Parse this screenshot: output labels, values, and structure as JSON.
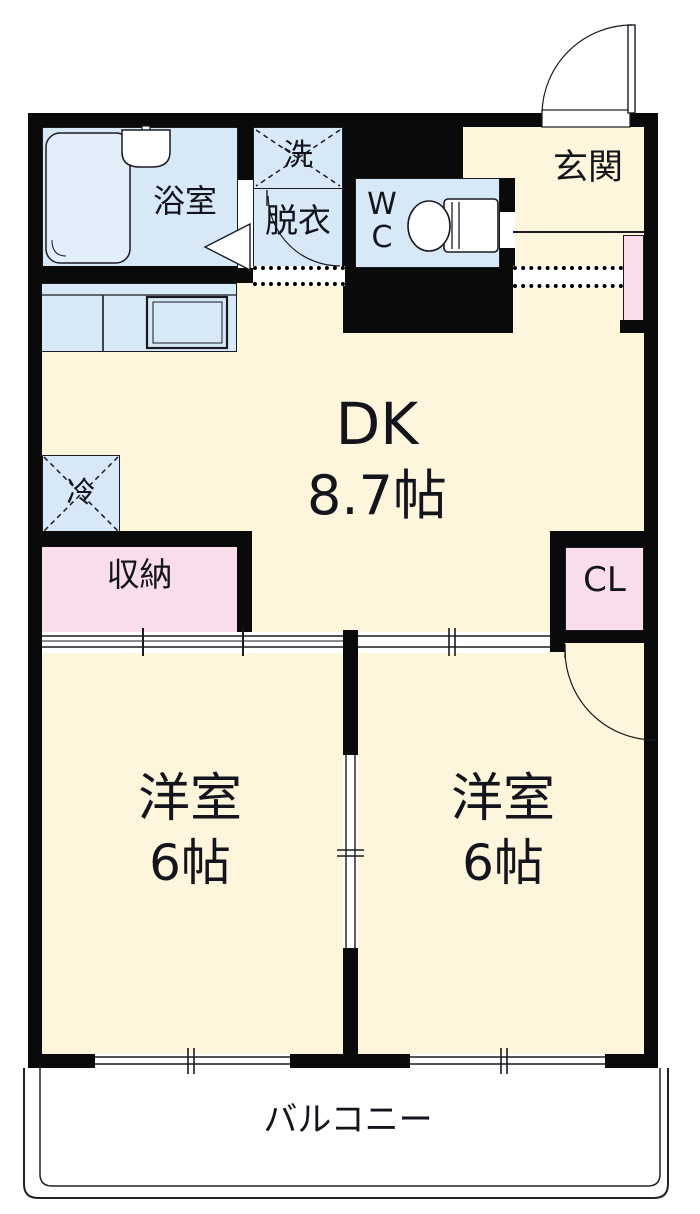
{
  "plan": {
    "type": "apartment-floorplan-2DK",
    "rooms": {
      "bath": {
        "label": "浴室"
      },
      "laundry": {
        "label": "洗"
      },
      "dressing": {
        "label": "脱衣"
      },
      "wc": {
        "label": "W\nC"
      },
      "entrance": {
        "label": "玄関"
      },
      "dk": {
        "name": "DK",
        "size": "8.7帖"
      },
      "fridge": {
        "label": "冷"
      },
      "storage": {
        "label": "収納"
      },
      "closet": {
        "label": "CL"
      },
      "room_left": {
        "name": "洋室",
        "size": "6帖"
      },
      "room_right": {
        "name": "洋室",
        "size": "6帖"
      },
      "balcony": {
        "label": "バルコニー"
      }
    },
    "colors": {
      "floor_cream": "#fdf5dc",
      "wet_blue": "#d7e9f6",
      "tub_blue": "#e2eefa",
      "closet_pink": "#f9ddeb",
      "wall_black": "#0a0a0a",
      "balcony_white": "#ffffff"
    }
  }
}
